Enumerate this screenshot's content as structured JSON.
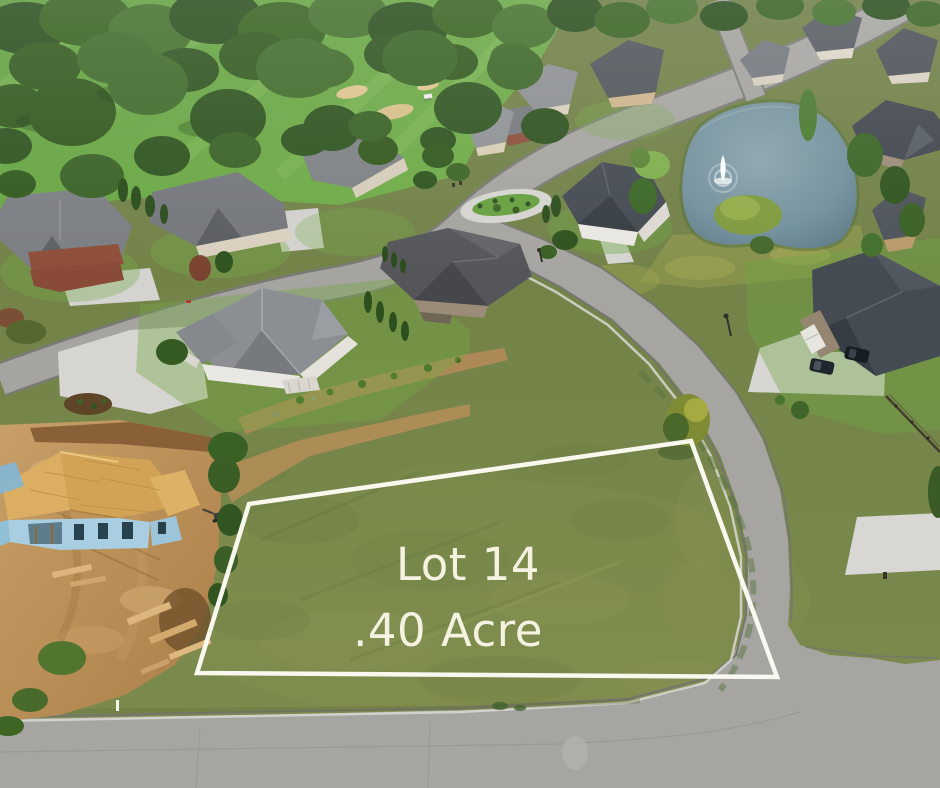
{
  "overlay": {
    "lot_label": "Lot 14",
    "acreage_label": ".40 Acre",
    "text_color": "#f6f2e2",
    "outline_color": "#fdfcf4",
    "outline_points": "249,504 691,441 777,677 197,673"
  },
  "scene": {
    "type": "aerial-drone-photo",
    "features": {
      "vacant_lot": "grass lot outlined in white",
      "pond": "neighborhood pond with fountain",
      "construction_site": "house under construction with exposed roof sheathing",
      "golf_course": "tree-lined golf course",
      "streets": "curving subdivision streets",
      "homes": "single-family homes with driveways"
    },
    "palette": {
      "grass": "#76864a",
      "fairway": "#68a744",
      "trees": "#33591f",
      "road": "#a6a5a1",
      "pond": "#72909c",
      "dirt": "#bb9058",
      "roof_sheathing": "#d9ae62",
      "wall_sheathing": "#a9cee1",
      "concrete": "#d7d6d2"
    }
  }
}
